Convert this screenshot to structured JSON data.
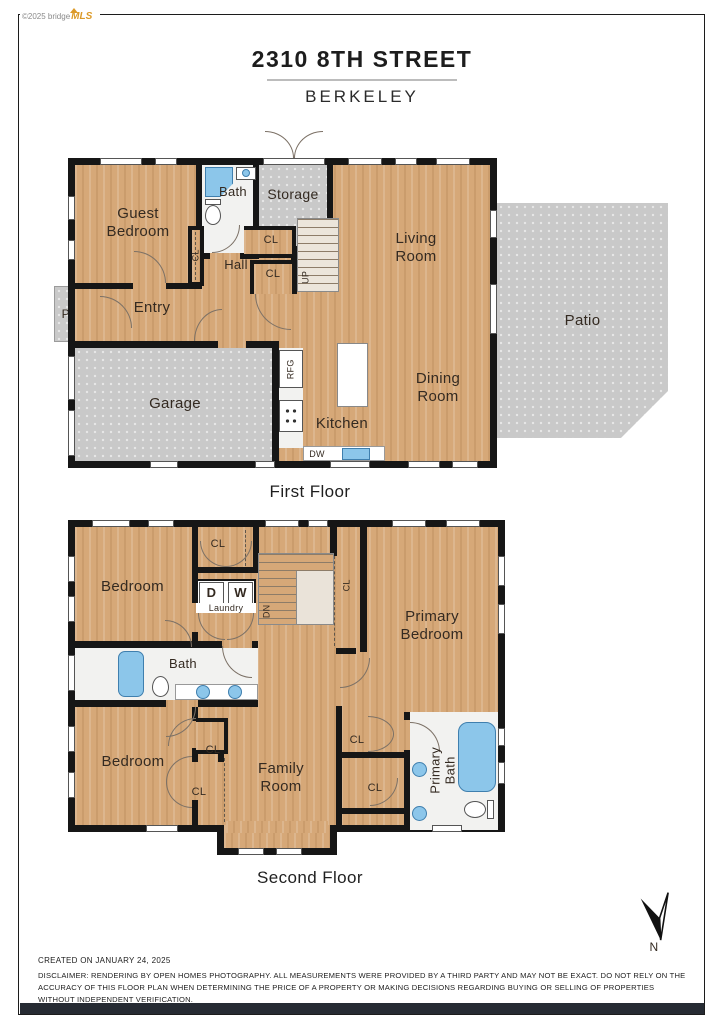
{
  "logo": {
    "copyright": "©2025 bridge",
    "brand": "MLS"
  },
  "header": {
    "title": "2310 8TH STREET",
    "subtitle": "BERKELEY"
  },
  "first_floor": {
    "caption": "First Floor",
    "rooms": {
      "guest_bedroom": "Guest Bedroom",
      "bath": "Bath",
      "storage": "Storage",
      "living_room": "Living Room",
      "hall": "Hall",
      "entry": "Entry",
      "porch": "Porch",
      "garage": "Garage",
      "kitchen": "Kitchen",
      "dining_room": "Dining Room",
      "patio": "Patio"
    },
    "annotations": {
      "cl": "CL",
      "up": "UP",
      "rfg": "RFG",
      "dw": "DW"
    }
  },
  "second_floor": {
    "caption": "Second Floor",
    "rooms": {
      "bedroom_top": "Bedroom",
      "bedroom_bottom": "Bedroom",
      "primary_bedroom": "Primary Bedroom",
      "family_room": "Family Room",
      "bath": "Bath",
      "primary_bath": "Primary Bath",
      "laundry": "Laundry"
    },
    "annotations": {
      "cl": "CL",
      "dn": "DN",
      "dryer": "D",
      "washer": "W"
    }
  },
  "compass": {
    "north": "N"
  },
  "footer": {
    "created": "CREATED ON JANUARY 24, 2025",
    "disclaimer": "DISCLAIMER: RENDERING BY OPEN HOMES PHOTOGRAPHY. ALL MEASUREMENTS WERE PROVIDED BY A THIRD PARTY AND MAY NOT BE EXACT. DO NOT RELY ON THE ACCURACY OF THIS FLOOR PLAN WHEN DETERMINING THE PRICE OF A PROPERTY OR MAKING DECISIONS REGARDING BUYING OR SELLING OF PROPERTIES WITHOUT INDEPENDENT VERIFICATION."
  },
  "palette": {
    "wood": "#d6a878",
    "concrete": "#c9c9c9",
    "wall": "#161616",
    "water": "#8cc6ea",
    "brand_orange": "#dc9a28"
  }
}
